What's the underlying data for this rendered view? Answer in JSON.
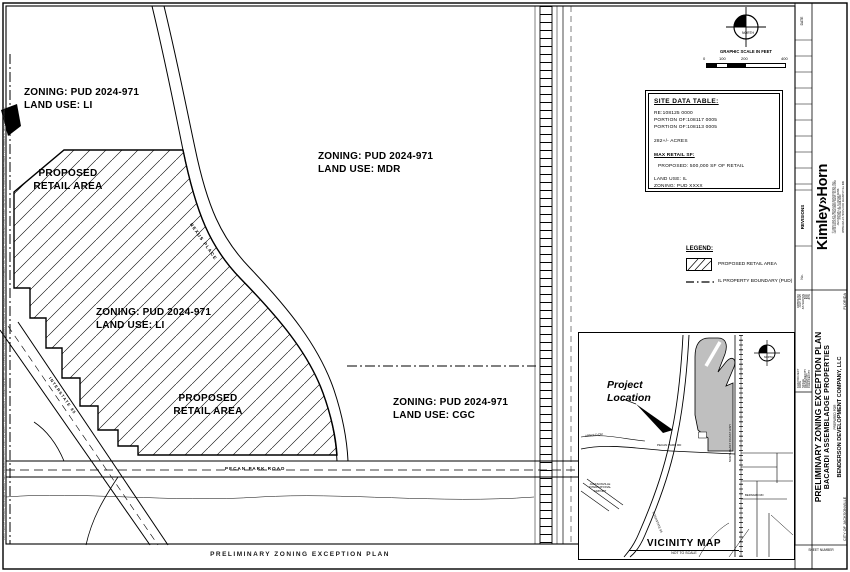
{
  "sheet": {
    "bottom_title": "PRELIMINARY ZONING EXCEPTION PLAN",
    "plot_stamp": "PLOTTED BY LARSEN, BENJAMIN  SHEET SET: ZONING LAYOUT1  JULY 14, 2025 - THIS DOCUMENT, TOGETHER WITH THE CONCEPTS AND DESIGNS PRESENTED HEREIN, AS AN INSTRUMENT OF SERVICE, IS INTENDED ONLY FOR THE SPECIFIC PURPOSE AND CLIENT FOR WHICH IT WAS PREPARED."
  },
  "plan": {
    "zoning_labels": [
      {
        "line1": "ZONING: PUD 2024-971",
        "line2": "LAND USE: LI"
      },
      {
        "line1": "ZONING: PUD 2024-971",
        "line2": "LAND USE: MDR"
      },
      {
        "line1": "ZONING: PUD 2024-971",
        "line2": "LAND USE: LI"
      },
      {
        "line1": "ZONING: PUD 2024-971",
        "line2": "LAND USE: CGC"
      }
    ],
    "retail_label": {
      "line1": "PROPOSED",
      "line2": "RETAIL AREA"
    },
    "roads": {
      "nexus_place": "NEXUS PLACE",
      "pecan_park": "PECAN PARK ROAD",
      "interstate": "INTERSTATE 95"
    },
    "north_label": "NORTH",
    "graphic_scale": {
      "title": "GRAPHIC SCALE IN FEET",
      "ticks": [
        "0",
        "100",
        "200",
        "400"
      ]
    }
  },
  "site_data_table": {
    "title": "SITE DATA TABLE:",
    "parcels": [
      "RE:108125 0000",
      "PORTION OF:108117 0005",
      "PORTION OF:108113 0005"
    ],
    "acreage": "282+/- ACRES",
    "max_retail_heading": "MAX RETAIL SF:",
    "max_retail_value": "PROPOSED: 500,000 SF OF RETAIL",
    "land_use": "LAND USE: IL",
    "zoning": "ZONING: PUD XXXX"
  },
  "legend": {
    "title": "LEGEND:",
    "retail_item": "PROPOSED RETAIL AREA",
    "boundary_item": "IL PROPERTY BOUNDARY (PUD)"
  },
  "vicinity": {
    "project_location_line1": "Project",
    "project_location_line2": "Location",
    "title": "VICINITY MAP",
    "subtitle": "NOT TO SCALE",
    "north_label": "NORTH",
    "roads": {
      "arnold": "ARNOLD DR",
      "pecan": "PECAN PARK RD",
      "bernard": "BERNARD RD",
      "interstate": "INTERSTATE 95",
      "coast_hwy": "NORTH EAST COAST HWY",
      "airport": "JACKSONVILLE INTERNATIONAL AIRPORT"
    }
  },
  "title_block": {
    "firm": "Kimley»Horn",
    "firm_info": [
      "© 2025 KIMLEY-HORN AND ASSOCIATES, INC.",
      "12740 GRAN BAY PARKWAY WEST, SUITE 2350",
      "JACKSONVILLE, FLORIDA 32258",
      "PHONE: 904-828-3900",
      "WWW.KIMLEY-HORN.COM  REGISTRY No. 696"
    ],
    "revisions": {
      "header": "REVISIONS",
      "date": "DATE",
      "number": "No."
    },
    "project_info": [
      {
        "label": "KHA PROJECT",
        "value": "048581210"
      },
      {
        "label": "DATE",
        "value": "JULY 2025"
      },
      {
        "label": "SCALE",
        "value": "AS SHOWN"
      },
      {
        "label": "DESIGNED BY",
        "value": "BJC"
      },
      {
        "label": "DRAWN BY",
        "value": "BJC"
      },
      {
        "label": "CHECKED BY",
        "value": "JPW"
      }
    ],
    "sheet_title": "PRELIMINARY ZONING EXCEPTION PLAN",
    "project_name": "BACARDI ASSEMBLADGE PROPERTIES",
    "prepared_for": "PREPARED FOR",
    "client": "BENDERSON DEVELOPMENT COMPANY, LLC",
    "city": "CITY OF JACKSONVILLE",
    "state": "FLORIDA",
    "sheet_number_label": "SHEET NUMBER"
  }
}
